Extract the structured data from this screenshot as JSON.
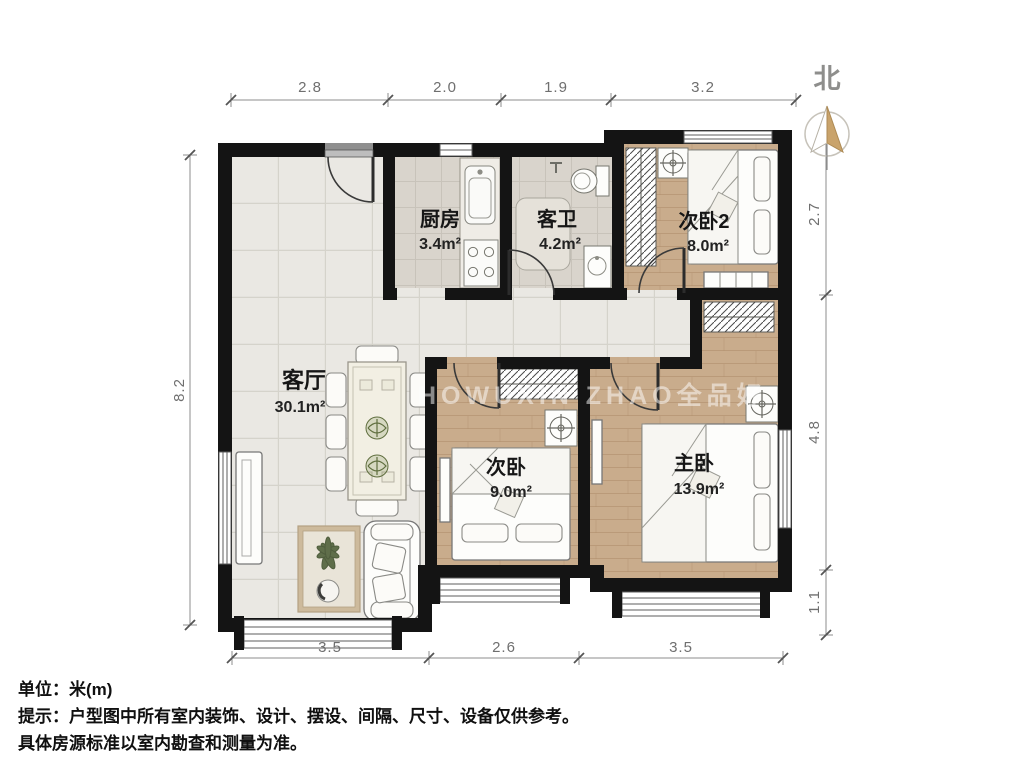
{
  "compass": {
    "north_label": "北"
  },
  "watermark": "HOWUXIN ZHAO全品好",
  "rooms": {
    "kitchen": {
      "name": "厨房",
      "area": "3.4m²"
    },
    "bath": {
      "name": "客卫",
      "area": "4.2m²"
    },
    "bedroom2": {
      "name": "次卧2",
      "area": "8.0m²"
    },
    "living": {
      "name": "客厅",
      "area": "30.1m²"
    },
    "bedroom": {
      "name": "次卧",
      "area": "9.0m²"
    },
    "master": {
      "name": "主卧",
      "area": "13.9m²"
    }
  },
  "dimensions": {
    "top": [
      "2.8",
      "2.0",
      "1.9",
      "3.2"
    ],
    "left": [
      "8.2"
    ],
    "right": [
      "2.7",
      "4.8",
      "1.1"
    ],
    "bottom": [
      "3.5",
      "2.6",
      "3.5"
    ]
  },
  "notes": {
    "unit": "单位：米(m)",
    "tip1": "提示：户型图中所有室内装饰、设计、摆设、间隔、尺寸、设备仅供参考。",
    "tip2": "具体房源标准以室内勘查和测量为准。"
  },
  "colors": {
    "wall": "#141414",
    "tile_floor": "#eae8e3",
    "kitchen_floor": "#dcd7cf",
    "wood_floor": "#c9ac8c",
    "compass_accent": "#c9a36b"
  }
}
